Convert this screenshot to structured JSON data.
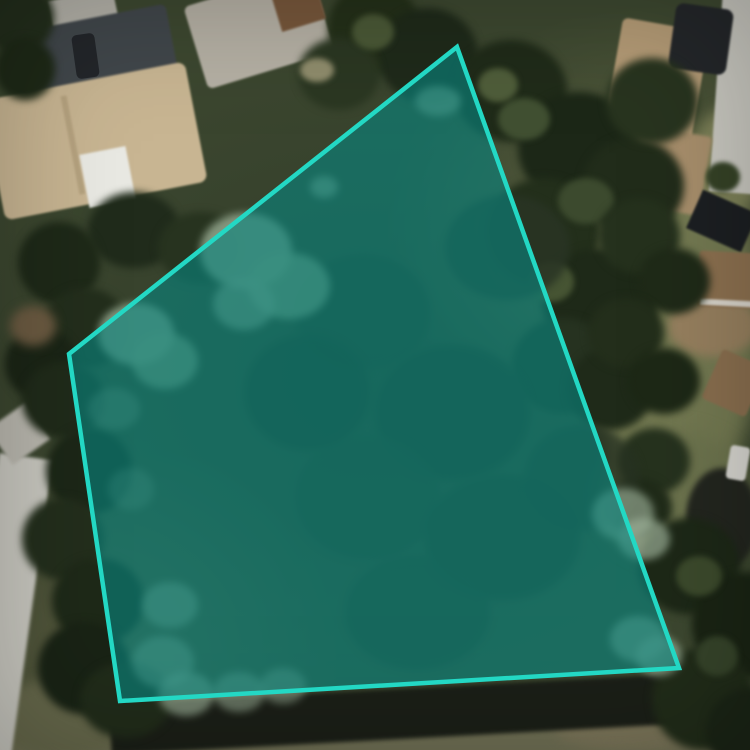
{
  "map": {
    "kind_label": "satellite-aerial-imagery",
    "colors": {
      "tree_dark": "#1f2a1b",
      "grass_olive": "#747a52",
      "roof_tan": "#c8b592",
      "roof_dark_gray": "#41474b",
      "roof_brown": "#8d7150",
      "road_gray": "#c8c7bf",
      "hedge_dark": "#1b1f17"
    }
  },
  "parcel": {
    "points": "457,47 679,668 120,701 69,354",
    "vertices": [
      [
        457,
        47
      ],
      [
        679,
        668
      ],
      [
        120,
        701
      ],
      [
        69,
        354
      ]
    ],
    "stroke": "#23d8c4",
    "fill": "rgba(8,132,126,0.62)",
    "stroke_width": "4.5"
  }
}
